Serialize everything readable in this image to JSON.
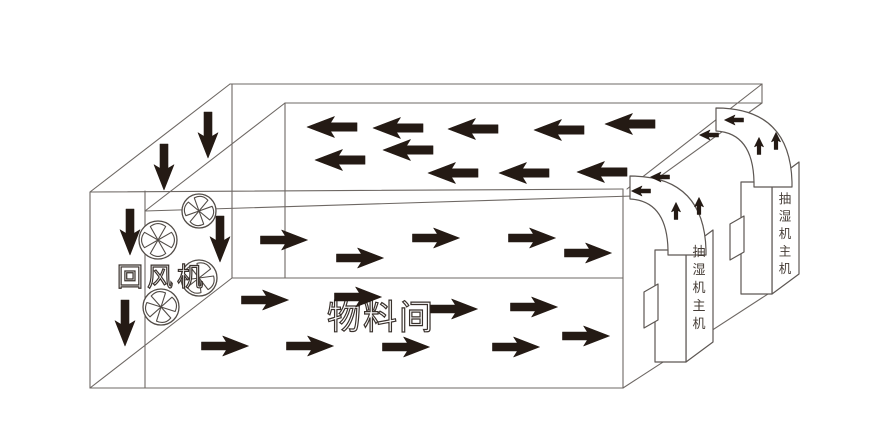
{
  "diagram": {
    "type": "drying-room-airflow-schematic",
    "background": "#ffffff",
    "colors": {
      "wireframe": "#6e6864",
      "unit_stroke": "#5d5753",
      "fan_stroke": "#514b46",
      "arrow": "#241a14",
      "label": "#453c36",
      "outline_label": "#3a322d"
    },
    "labels": {
      "return_fan": {
        "text": "回风机",
        "x": 162,
        "y": 286,
        "size": 26,
        "spacing": 4,
        "style": "outline"
      },
      "material_room": {
        "text": "物料间",
        "x": 381,
        "y": 329,
        "size": 34,
        "spacing": 2,
        "style": "outline"
      },
      "dehumidifier_front": {
        "text": "抽湿机主机",
        "x": 699,
        "y": 256,
        "step": 18,
        "size": 13,
        "style": "vertical"
      },
      "dehumidifier_back": {
        "text": "抽湿机主机",
        "x": 785,
        "y": 203,
        "step": 17.5,
        "size": 12.5,
        "style": "vertical"
      }
    },
    "wireframe": [
      [
        90,
        192,
        230,
        84
      ],
      [
        230,
        84,
        762,
        84
      ],
      [
        762,
        84,
        762,
        103
      ],
      [
        285,
        103,
        762,
        103
      ],
      [
        285,
        103,
        145,
        211
      ],
      [
        90,
        192,
        90,
        388
      ],
      [
        90,
        388,
        623,
        388
      ],
      [
        623,
        189,
        623,
        388
      ],
      [
        90,
        192,
        623,
        189
      ],
      [
        145,
        211,
        633,
        196
      ],
      [
        145,
        191,
        145,
        388
      ],
      [
        232,
        84,
        232,
        278
      ],
      [
        285,
        103,
        285,
        278
      ],
      [
        232,
        278,
        623,
        278
      ],
      [
        90,
        388,
        232,
        278
      ],
      [
        762,
        84,
        627,
        189
      ],
      [
        762,
        103,
        633,
        196
      ],
      [
        623,
        388,
        788,
        281
      ],
      [
        788,
        281,
        788,
        168
      ]
    ],
    "units": [
      {
        "name": "dehumidifier-back-side",
        "d": "M772,182 L799,162 L799,274 L772,294 Z"
      },
      {
        "name": "dehumidifier-back-front",
        "d": "M741,182 L772,182 L772,294 L741,294 Z"
      },
      {
        "name": "dehumidifier-back-handle",
        "d": "M730,224 L744,216 L744,252 L730,260 Z"
      },
      {
        "name": "duct-back",
        "d": "M716,108 Q790,108 792,182 L792,187 L754,187 L754,182 Q753,133 716,131 Z"
      },
      {
        "name": "dehumidifier-front-side",
        "d": "M686,250 L713,230 L713,342 L686,362 Z"
      },
      {
        "name": "dehumidifier-front-front",
        "d": "M655,250 L686,250 L686,362 L655,362 Z"
      },
      {
        "name": "dehumidifier-front-handle",
        "d": "M644,292 L658,284 L658,320 L644,328 Z"
      },
      {
        "name": "duct-front",
        "d": "M630,176 Q704,176 706,250 L706,255 L668,255 L668,250 Q667,201 630,199 Z"
      }
    ],
    "fans": [
      {
        "cx": 199,
        "cy": 211,
        "r": 17,
        "rot": 10
      },
      {
        "cx": 158,
        "cy": 240,
        "r": 19,
        "rot": 0
      },
      {
        "cx": 199,
        "cy": 278,
        "r": 18,
        "rot": 22
      },
      {
        "cx": 161,
        "cy": 307,
        "r": 18,
        "rot": -12
      }
    ],
    "arrows": {
      "roof_left": {
        "dir": "left",
        "l": 50,
        "h": 21,
        "points": [
          [
            332,
            127
          ],
          [
            398,
            128
          ],
          [
            473,
            129
          ],
          [
            559,
            130
          ],
          [
            630,
            124
          ],
          [
            340,
            160
          ],
          [
            408,
            150
          ],
          [
            453,
            173
          ],
          [
            524,
            173
          ],
          [
            602,
            172
          ]
        ]
      },
      "middle_right": {
        "dir": "right",
        "l": 47,
        "h": 20,
        "points": [
          [
            284,
            240
          ],
          [
            360,
            258
          ],
          [
            436,
            238
          ],
          [
            532,
            238
          ],
          [
            588,
            253
          ]
        ]
      },
      "bottom_right": {
        "dir": "right",
        "l": 47,
        "h": 20,
        "points": [
          [
            265,
            300
          ],
          [
            358,
            297
          ],
          [
            454,
            309
          ],
          [
            534,
            307
          ],
          [
            225,
            346
          ],
          [
            310,
            346
          ],
          [
            406,
            347
          ],
          [
            516,
            347
          ],
          [
            586,
            336
          ]
        ]
      },
      "down": {
        "dir": "down",
        "l": 46,
        "h": 20,
        "points": [
          [
            164,
            167
          ],
          [
            208,
            135
          ],
          [
            130,
            232
          ],
          [
            125,
            323
          ],
          [
            220,
            239
          ]
        ]
      },
      "duct_exit_left": {
        "dir": "left",
        "l": 19,
        "h": 10,
        "points": [
          [
            641,
            191
          ],
          [
            660,
            177
          ],
          [
            709,
            135
          ],
          [
            734,
            120
          ]
        ]
      },
      "duct_up": {
        "dir": "up",
        "l": 17,
        "h": 9,
        "points": [
          [
            676,
            211
          ],
          [
            699,
            206
          ],
          [
            759,
            146
          ],
          [
            776,
            141
          ]
        ]
      }
    }
  }
}
